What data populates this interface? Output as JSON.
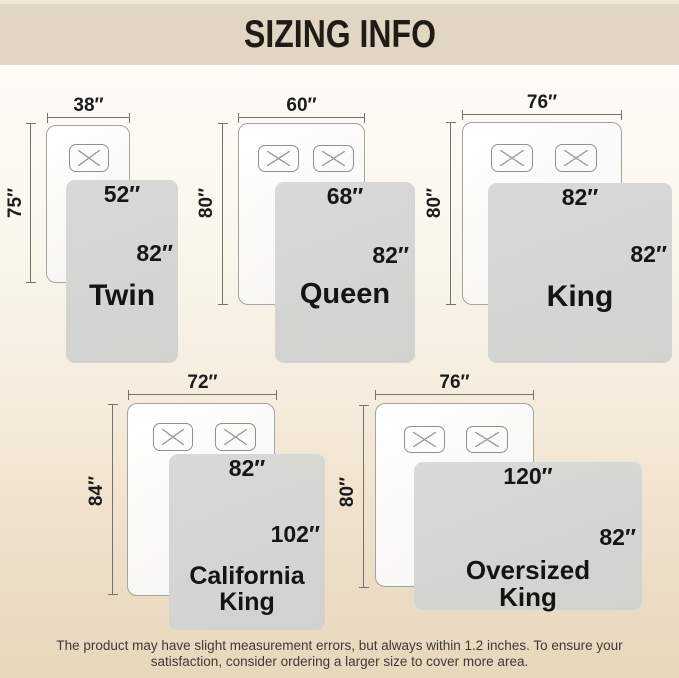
{
  "header": {
    "title": "SIZING INFO"
  },
  "sizes": [
    {
      "name": "Twin",
      "bed_width": "38″",
      "bed_length": "75″",
      "blanket_width": "52″",
      "blanket_length": "82″",
      "pillows": 1
    },
    {
      "name": "Queen",
      "bed_width": "60″",
      "bed_length": "80″",
      "blanket_width": "68″",
      "blanket_length": "82″",
      "pillows": 2
    },
    {
      "name": "King",
      "bed_width": "76″",
      "bed_length": "80″",
      "blanket_width": "82″",
      "blanket_length": "82″",
      "pillows": 2
    },
    {
      "name": "California King",
      "bed_width": "72″",
      "bed_length": "84″",
      "blanket_width": "82″",
      "blanket_length": "102″",
      "pillows": 2
    },
    {
      "name": "Oversized King",
      "bed_width": "76″",
      "bed_length": "80″",
      "blanket_width": "120″",
      "blanket_length": "82″",
      "pillows": 2
    }
  ],
  "footer": {
    "line1": "The product may have slight measurement errors, but always within 1.2 inches. To ensure your",
    "line2": "satisfaction, consider ordering a larger size to cover more area."
  },
  "colors": {
    "band": "#e1d6c3",
    "blanket": "#d5d5d2",
    "bed_border": "#a3a3a0",
    "dimension_line": "#72726f",
    "label_text": "#1c1c1c",
    "footer_text": "#3e3a33",
    "background_top": "#fdfcf6",
    "background_bottom": "#e7d7bc"
  }
}
